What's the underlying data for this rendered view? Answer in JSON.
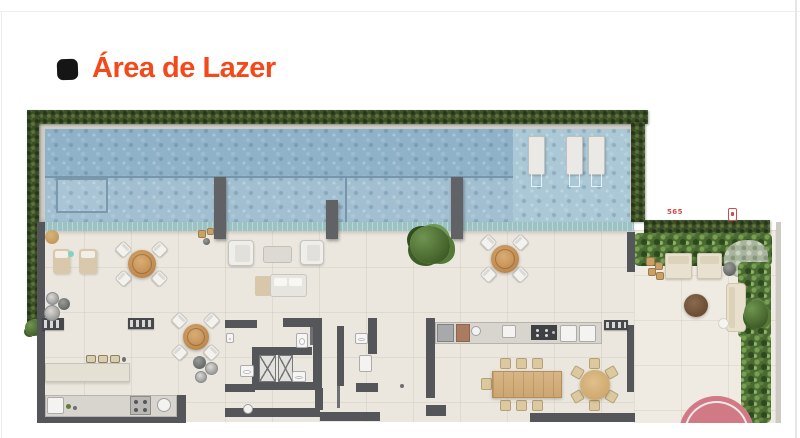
{
  "header": {
    "title": "Área de Lazer"
  },
  "plan": {
    "labels": {
      "dimension": "565"
    },
    "colors": {
      "title": "#f4491a",
      "label": "#cf4b4b",
      "hedge": "#3c4c27",
      "garden": "#4b6a33",
      "pool-deep": "#8fb2c9",
      "pool-mid": "#a2bfd1",
      "pool-shallow": "#abc8d6",
      "edge": "#9dc2c3",
      "deck": "#ebe7de",
      "wall": "#54565a",
      "coping": "#cfccc5",
      "wood": "#c08b50",
      "rug": "#d27986"
    },
    "items": [
      {
        "t": "deck",
        "n": "main-deck-floor",
        "x": 37,
        "y": 222,
        "w": 597,
        "h": 200
      },
      {
        "t": "deck deck2",
        "n": "garden-floor",
        "x": 634,
        "y": 230,
        "w": 143,
        "h": 193
      },
      {
        "t": "coping",
        "n": "pool-coping",
        "x": 39,
        "y": 120,
        "w": 603,
        "h": 102
      },
      {
        "t": "pool-deep",
        "n": "pool-deep-water",
        "x": 45,
        "y": 129,
        "w": 585,
        "h": 48
      },
      {
        "t": "pool-mid",
        "n": "pool-lap-section",
        "x": 45,
        "y": 177,
        "w": 468,
        "h": 45
      },
      {
        "t": "pool-shallow",
        "n": "pool-shallow-platform",
        "x": 513,
        "y": 129,
        "w": 117,
        "h": 93
      },
      {
        "t": "pool-line-h",
        "x": 45,
        "y": 176,
        "w": 468,
        "h": 2
      },
      {
        "t": "pool-line-v",
        "x": 345,
        "y": 177,
        "w": 2,
        "h": 45
      },
      {
        "t": "pool-step",
        "n": "pool-steps",
        "x": 56,
        "y": 178,
        "w": 52,
        "h": 35
      },
      {
        "t": "edge-strip",
        "n": "pool-infinity-edge",
        "x": 42,
        "y": 222,
        "w": 592,
        "h": 9
      },
      {
        "t": "pool-lounger",
        "n": "in-pool-lounger",
        "x": 528,
        "y": 136,
        "w": 17,
        "h": 39
      },
      {
        "t": "pool-lounger",
        "n": "in-pool-lounger",
        "x": 566,
        "y": 136,
        "w": 17,
        "h": 39
      },
      {
        "t": "pool-lounger",
        "n": "in-pool-lounger",
        "x": 588,
        "y": 136,
        "w": 17,
        "h": 39
      },
      {
        "t": "hedge",
        "n": "hedge-top",
        "x": 27,
        "y": 110,
        "w": 621,
        "h": 14
      },
      {
        "t": "hedge",
        "n": "hedge-left",
        "x": 27,
        "y": 110,
        "w": 12,
        "h": 223
      },
      {
        "t": "hedge",
        "n": "hedge-right",
        "x": 631,
        "y": 122,
        "w": 14,
        "h": 100
      },
      {
        "t": "hedge",
        "n": "hedge-terrace",
        "x": 644,
        "y": 220,
        "w": 126,
        "h": 13
      },
      {
        "t": "plant-blob",
        "x": 25,
        "y": 320,
        "w": 16,
        "h": 16
      },
      {
        "t": "garden",
        "n": "garden-bed-top",
        "x": 634,
        "y": 233,
        "w": 138,
        "h": 33
      },
      {
        "t": "shrub",
        "n": "gray-shrub",
        "x": 724,
        "y": 240,
        "w": 44,
        "h": 38
      },
      {
        "t": "garden",
        "n": "garden-bed-right",
        "x": 738,
        "y": 262,
        "w": 33,
        "h": 76
      },
      {
        "t": "garden",
        "n": "garden-bed-right-lower",
        "x": 741,
        "y": 334,
        "w": 30,
        "h": 89
      },
      {
        "t": "wall-light",
        "n": "garden-right-wall",
        "x": 776,
        "y": 222,
        "w": 5,
        "h": 201
      },
      {
        "t": "pillar",
        "x": 214,
        "y": 177,
        "w": 12,
        "h": 62
      },
      {
        "t": "pillar",
        "x": 326,
        "y": 200,
        "w": 12,
        "h": 39
      },
      {
        "t": "pillar",
        "x": 451,
        "y": 177,
        "w": 12,
        "h": 62
      },
      {
        "t": "wall",
        "n": "wall-left",
        "x": 37,
        "y": 222,
        "w": 8,
        "h": 200
      },
      {
        "t": "wall",
        "n": "wall-bottom-left",
        "x": 37,
        "y": 415,
        "w": 149,
        "h": 8
      },
      {
        "t": "wall",
        "x": 177,
        "y": 395,
        "w": 9,
        "h": 28
      },
      {
        "t": "wall",
        "n": "wall-bottom-lobby",
        "x": 225,
        "y": 408,
        "w": 95,
        "h": 9
      },
      {
        "t": "wall",
        "x": 320,
        "y": 412,
        "w": 60,
        "h": 9
      },
      {
        "t": "wall",
        "n": "wall-bottom-right",
        "x": 530,
        "y": 413,
        "w": 104,
        "h": 9
      },
      {
        "t": "wall",
        "x": 627,
        "y": 232,
        "w": 8,
        "h": 40
      },
      {
        "t": "wall",
        "x": 627,
        "y": 325,
        "w": 7,
        "h": 67
      },
      {
        "t": "wall",
        "x": 627,
        "y": 413,
        "w": 8,
        "h": 9
      },
      {
        "t": "wall",
        "n": "wall-wc-top-a",
        "x": 225,
        "y": 320,
        "w": 32,
        "h": 8
      },
      {
        "t": "wall",
        "n": "wall-wc-top-b",
        "x": 283,
        "y": 318,
        "w": 30,
        "h": 9
      },
      {
        "t": "wall",
        "x": 313,
        "y": 318,
        "w": 9,
        "h": 72
      },
      {
        "t": "wall",
        "x": 252,
        "y": 347,
        "w": 60,
        "h": 8
      },
      {
        "t": "wall",
        "x": 252,
        "y": 347,
        "w": 7,
        "h": 43
      },
      {
        "t": "wall",
        "x": 252,
        "y": 382,
        "w": 70,
        "h": 8
      },
      {
        "t": "wall",
        "x": 225,
        "y": 384,
        "w": 30,
        "h": 8
      },
      {
        "t": "wall",
        "x": 315,
        "y": 388,
        "w": 8,
        "h": 22
      },
      {
        "t": "elevator",
        "n": "elevator-1",
        "x": 259,
        "y": 355,
        "w": 17,
        "h": 27
      },
      {
        "t": "elevator",
        "n": "elevator-2",
        "x": 278,
        "y": 355,
        "w": 15,
        "h": 27
      },
      {
        "t": "fixture",
        "n": "toilet",
        "x": 240,
        "y": 365,
        "w": 14,
        "h": 12
      },
      {
        "t": "fixture",
        "n": "toilet",
        "x": 296,
        "y": 333,
        "w": 12,
        "h": 15
      },
      {
        "t": "fixture",
        "n": "toilet",
        "x": 292,
        "y": 371,
        "w": 14,
        "h": 11
      },
      {
        "t": "fixture",
        "n": "washbasin",
        "x": 226,
        "y": 333,
        "w": 8,
        "h": 10
      },
      {
        "t": "door-leaf",
        "x": 310,
        "y": 327,
        "w": 3,
        "h": 18
      },
      {
        "t": "wall",
        "n": "wall-wc-mid",
        "x": 337,
        "y": 326,
        "w": 7,
        "h": 60
      },
      {
        "t": "door-leaf",
        "x": 337,
        "y": 386,
        "w": 3,
        "h": 22
      },
      {
        "t": "wall",
        "x": 368,
        "y": 318,
        "w": 9,
        "h": 36
      },
      {
        "t": "fixture",
        "n": "toilet",
        "x": 355,
        "y": 333,
        "w": 13,
        "h": 11
      },
      {
        "t": "sink-square",
        "n": "washbasin",
        "x": 359,
        "y": 355,
        "w": 13,
        "h": 17
      },
      {
        "t": "wall",
        "x": 356,
        "y": 383,
        "w": 22,
        "h": 9
      },
      {
        "t": "dot-dark",
        "n": "door-pivot",
        "x": 400,
        "y": 384,
        "w": 4,
        "h": 4
      },
      {
        "t": "wall",
        "n": "wall-kitchen",
        "x": 426,
        "y": 318,
        "w": 9,
        "h": 80
      },
      {
        "t": "wall",
        "x": 426,
        "y": 405,
        "w": 20,
        "h": 11
      },
      {
        "t": "counter",
        "n": "gourmet-counter",
        "x": 435,
        "y": 322,
        "w": 167,
        "h": 22
      },
      {
        "t": "appliance-steel",
        "n": "oven",
        "x": 437,
        "y": 324,
        "w": 17,
        "h": 18
      },
      {
        "t": "appliance-wood",
        "n": "cutting-board",
        "x": 456,
        "y": 324,
        "w": 14,
        "h": 18
      },
      {
        "t": "sink-round",
        "n": "counter-sink",
        "x": 471,
        "y": 326,
        "w": 10,
        "h": 10
      },
      {
        "t": "sink-square",
        "n": "counter-sink",
        "x": 502,
        "y": 325,
        "w": 14,
        "h": 13
      },
      {
        "t": "stove-dark",
        "n": "cooktop",
        "x": 531,
        "y": 325,
        "w": 26,
        "h": 15
      },
      {
        "t": "sink-square",
        "x": 560,
        "y": 325,
        "w": 17,
        "h": 17
      },
      {
        "t": "sink-square",
        "x": 579,
        "y": 325,
        "w": 17,
        "h": 17
      },
      {
        "t": "grill",
        "n": "barbecue-grill",
        "x": 604,
        "y": 320,
        "w": 24,
        "h": 10
      },
      {
        "t": "chair-wood",
        "x": 500,
        "y": 358,
        "w": 11,
        "h": 11
      },
      {
        "t": "chair-wood",
        "x": 516,
        "y": 358,
        "w": 11,
        "h": 11
      },
      {
        "t": "chair-wood",
        "x": 532,
        "y": 358,
        "w": 11,
        "h": 11
      },
      {
        "t": "chair-wood",
        "x": 500,
        "y": 400,
        "w": 11,
        "h": 11
      },
      {
        "t": "chair-wood",
        "x": 516,
        "y": 400,
        "w": 11,
        "h": 11
      },
      {
        "t": "chair-wood",
        "x": 532,
        "y": 400,
        "w": 11,
        "h": 11
      },
      {
        "t": "chair-wood",
        "x": 481,
        "y": 378,
        "w": 11,
        "h": 12
      },
      {
        "t": "table-wood",
        "n": "dining-table",
        "x": 492,
        "y": 371,
        "w": 70,
        "h": 27
      },
      {
        "t": "chair-wood",
        "x": 589,
        "y": 358,
        "w": 11,
        "h": 11
      },
      {
        "t": "chair-wood",
        "x": 606,
        "y": 367,
        "w": 11,
        "h": 11,
        "r": 60
      },
      {
        "t": "chair-wood",
        "x": 606,
        "y": 391,
        "w": 11,
        "h": 11,
        "r": -60
      },
      {
        "t": "chair-wood",
        "x": 589,
        "y": 400,
        "w": 11,
        "h": 11
      },
      {
        "t": "chair-wood",
        "x": 572,
        "y": 391,
        "w": 11,
        "h": 11,
        "r": 60
      },
      {
        "t": "chair-wood",
        "x": 572,
        "y": 367,
        "w": 11,
        "h": 11,
        "r": -60
      },
      {
        "t": "table-round-wood",
        "n": "round-dining-table",
        "x": 580,
        "y": 370,
        "w": 30,
        "h": 30
      },
      {
        "t": "counter",
        "n": "kitchen-counter",
        "x": 45,
        "y": 395,
        "w": 132,
        "h": 22
      },
      {
        "t": "sink-square",
        "n": "kitchen-sink",
        "x": 47,
        "y": 397,
        "w": 17,
        "h": 17
      },
      {
        "t": "stove-gray",
        "n": "cooktop",
        "x": 130,
        "y": 396,
        "w": 21,
        "h": 19
      },
      {
        "t": "sink-round",
        "n": "kitchen-sink",
        "x": 157,
        "y": 398,
        "w": 14,
        "h": 14
      },
      {
        "t": "dot-green",
        "x": 66,
        "y": 404,
        "w": 5,
        "h": 5
      },
      {
        "t": "dot-dark",
        "x": 73,
        "y": 406,
        "w": 4,
        "h": 4
      },
      {
        "t": "sink-round",
        "n": "floor-drain",
        "x": 243,
        "y": 404,
        "w": 10,
        "h": 10
      },
      {
        "t": "grill",
        "n": "barbecue-grill",
        "x": 42,
        "y": 318,
        "w": 22,
        "h": 12
      },
      {
        "t": "grill",
        "n": "barbecue-grill",
        "x": 128,
        "y": 318,
        "w": 26,
        "h": 11
      },
      {
        "t": "bench",
        "n": "bench-counter",
        "x": 45,
        "y": 363,
        "w": 85,
        "h": 19
      },
      {
        "t": "stool",
        "x": 86,
        "y": 355,
        "w": 10,
        "h": 8
      },
      {
        "t": "stool",
        "x": 98,
        "y": 355,
        "w": 10,
        "h": 8
      },
      {
        "t": "stool",
        "x": 110,
        "y": 355,
        "w": 10,
        "h": 8
      },
      {
        "t": "dot-dark",
        "x": 122,
        "y": 357,
        "w": 4,
        "h": 5
      },
      {
        "t": "pouf",
        "x": 45,
        "y": 230,
        "w": 14,
        "h": 14
      },
      {
        "t": "mat",
        "n": "sun-mat",
        "x": 53,
        "y": 249,
        "w": 17,
        "h": 25
      },
      {
        "t": "mat",
        "n": "sun-mat",
        "x": 79,
        "y": 249,
        "w": 18,
        "h": 25
      },
      {
        "t": "dot-teal",
        "x": 68,
        "y": 251,
        "w": 6,
        "h": 6
      },
      {
        "t": "pot",
        "x": 46,
        "y": 292,
        "w": 13,
        "h": 13
      },
      {
        "t": "pot-dark",
        "x": 58,
        "y": 298,
        "w": 12,
        "h": 12
      },
      {
        "t": "pot",
        "x": 44,
        "y": 305,
        "w": 16,
        "h": 16
      },
      {
        "t": "pot-dark",
        "x": 193,
        "y": 356,
        "w": 13,
        "h": 13
      },
      {
        "t": "pot",
        "x": 205,
        "y": 362,
        "w": 13,
        "h": 13
      },
      {
        "t": "pot",
        "x": 195,
        "y": 371,
        "w": 12,
        "h": 12
      },
      {
        "t": "chair",
        "x": 117,
        "y": 243,
        "w": 13,
        "h": 13,
        "r": 45
      },
      {
        "t": "chair",
        "x": 153,
        "y": 243,
        "w": 13,
        "h": 13,
        "r": -45
      },
      {
        "t": "chair",
        "x": 117,
        "y": 272,
        "w": 13,
        "h": 13,
        "r": -45
      },
      {
        "t": "chair",
        "x": 153,
        "y": 272,
        "w": 13,
        "h": 13,
        "r": 45
      },
      {
        "t": "table-round",
        "n": "bistro-table",
        "x": 128,
        "y": 250,
        "w": 28,
        "h": 28
      },
      {
        "t": "chair",
        "x": 173,
        "y": 314,
        "w": 13,
        "h": 13,
        "r": 45
      },
      {
        "t": "chair",
        "x": 205,
        "y": 314,
        "w": 13,
        "h": 13,
        "r": -45
      },
      {
        "t": "chair",
        "x": 173,
        "y": 346,
        "w": 13,
        "h": 13,
        "r": -45
      },
      {
        "t": "chair",
        "x": 205,
        "y": 346,
        "w": 13,
        "h": 13,
        "r": 45
      },
      {
        "t": "table-round",
        "n": "bistro-table",
        "x": 183,
        "y": 324,
        "w": 26,
        "h": 26
      },
      {
        "t": "chair",
        "x": 482,
        "y": 236,
        "w": 13,
        "h": 13,
        "r": 45
      },
      {
        "t": "chair",
        "x": 514,
        "y": 236,
        "w": 13,
        "h": 13,
        "r": -45
      },
      {
        "t": "chair",
        "x": 482,
        "y": 268,
        "w": 13,
        "h": 13,
        "r": -45
      },
      {
        "t": "chair",
        "x": 514,
        "y": 268,
        "w": 13,
        "h": 13,
        "r": 45
      },
      {
        "t": "table-round",
        "n": "bistro-table",
        "x": 491,
        "y": 245,
        "w": 28,
        "h": 28
      },
      {
        "t": "armchair",
        "x": 228,
        "y": 240,
        "w": 26,
        "h": 26
      },
      {
        "t": "side-table",
        "n": "coffee-table",
        "x": 263,
        "y": 246,
        "w": 29,
        "h": 17
      },
      {
        "t": "armchair",
        "x": 300,
        "y": 240,
        "w": 24,
        "h": 25
      },
      {
        "t": "daybed-base",
        "x": 255,
        "y": 276,
        "w": 16,
        "h": 20
      },
      {
        "t": "daybed",
        "n": "daybed",
        "x": 270,
        "y": 274,
        "w": 37,
        "h": 23
      },
      {
        "t": "side-table-wood",
        "x": 198,
        "y": 230,
        "w": 8,
        "h": 8
      },
      {
        "t": "side-table-wood",
        "x": 207,
        "y": 228,
        "w": 7,
        "h": 7
      },
      {
        "t": "pot-dark",
        "x": 203,
        "y": 238,
        "w": 7,
        "h": 7
      },
      {
        "t": "plant-big",
        "n": "potted-plant",
        "x": 410,
        "y": 226,
        "w": 40,
        "h": 38
      },
      {
        "t": "side-table-wood",
        "x": 646,
        "y": 257,
        "w": 9,
        "h": 9
      },
      {
        "t": "side-table-wood",
        "x": 655,
        "y": 262,
        "w": 8,
        "h": 8
      },
      {
        "t": "side-table-wood",
        "x": 648,
        "y": 268,
        "w": 8,
        "h": 8
      },
      {
        "t": "side-table-wood",
        "x": 656,
        "y": 272,
        "w": 8,
        "h": 8
      },
      {
        "t": "lounger-garden",
        "x": 665,
        "y": 253,
        "w": 27,
        "h": 26
      },
      {
        "t": "lounger-garden",
        "x": 697,
        "y": 253,
        "w": 25,
        "h": 26
      },
      {
        "t": "pot-dark",
        "x": 723,
        "y": 262,
        "w": 13,
        "h": 14
      },
      {
        "t": "table-brown",
        "n": "side-table-round",
        "x": 684,
        "y": 294,
        "w": 24,
        "h": 23
      },
      {
        "t": "sofa-garden",
        "n": "garden-sofa",
        "x": 726,
        "y": 283,
        "w": 20,
        "h": 49
      },
      {
        "t": "ball-white",
        "x": 718,
        "y": 318,
        "w": 11,
        "h": 11
      },
      {
        "t": "plant-blob",
        "x": 744,
        "y": 300,
        "w": 24,
        "h": 28
      },
      {
        "t": "rug-pink",
        "n": "round-rug",
        "x": 679,
        "y": 396,
        "w": 75,
        "h": 27
      },
      {
        "t": "label-red",
        "n": "dimension-label",
        "x": 662,
        "y": 207,
        "w": 26,
        "h": 10,
        "text": "565"
      },
      {
        "t": "marker-red",
        "n": "red-marker-icon",
        "x": 728,
        "y": 208,
        "w": 9,
        "h": 13
      }
    ]
  }
}
